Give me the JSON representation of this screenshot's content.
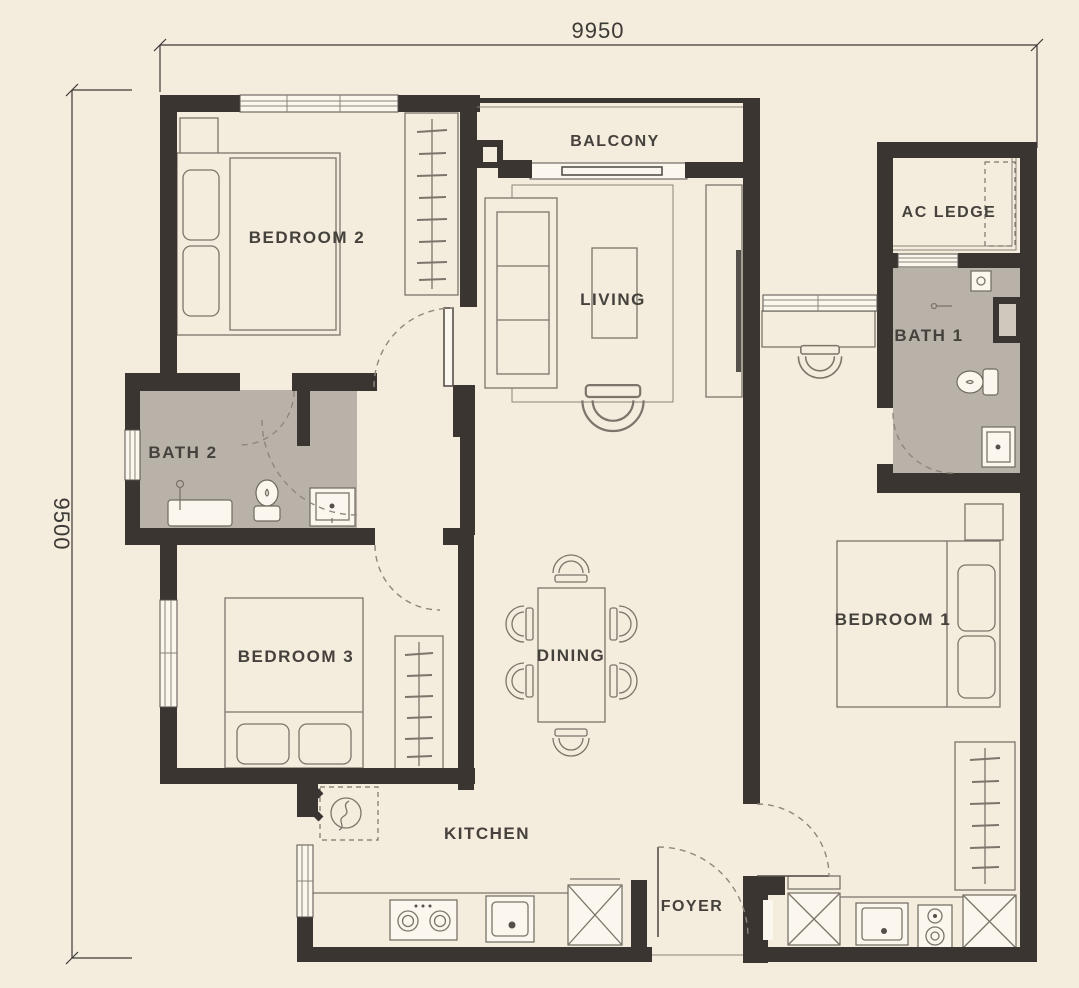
{
  "plan": {
    "type": "apartment-floor-plan",
    "dimensions": {
      "width_label": "9950",
      "height_label": "9500"
    },
    "rooms": [
      {
        "id": "bedroom-2",
        "label": "BEDROOM 2"
      },
      {
        "id": "balcony",
        "label": "BALCONY"
      },
      {
        "id": "living",
        "label": "LIVING"
      },
      {
        "id": "ac-ledge",
        "label": "AC LEDGE"
      },
      {
        "id": "bath-1",
        "label": "BATH 1"
      },
      {
        "id": "bath-2",
        "label": "BATH 2"
      },
      {
        "id": "bedroom-3",
        "label": "BEDROOM 3"
      },
      {
        "id": "dining",
        "label": "DINING"
      },
      {
        "id": "bedroom-1",
        "label": "BEDROOM 1"
      },
      {
        "id": "kitchen",
        "label": "KITCHEN"
      },
      {
        "id": "foyer",
        "label": "FOYER"
      }
    ],
    "colors": {
      "background": "#F4ECDC",
      "wall": "#3A3531",
      "bath_floor": "#B9B2A8",
      "furniture_line": "#7B756B",
      "label_text": "#45413C"
    }
  }
}
